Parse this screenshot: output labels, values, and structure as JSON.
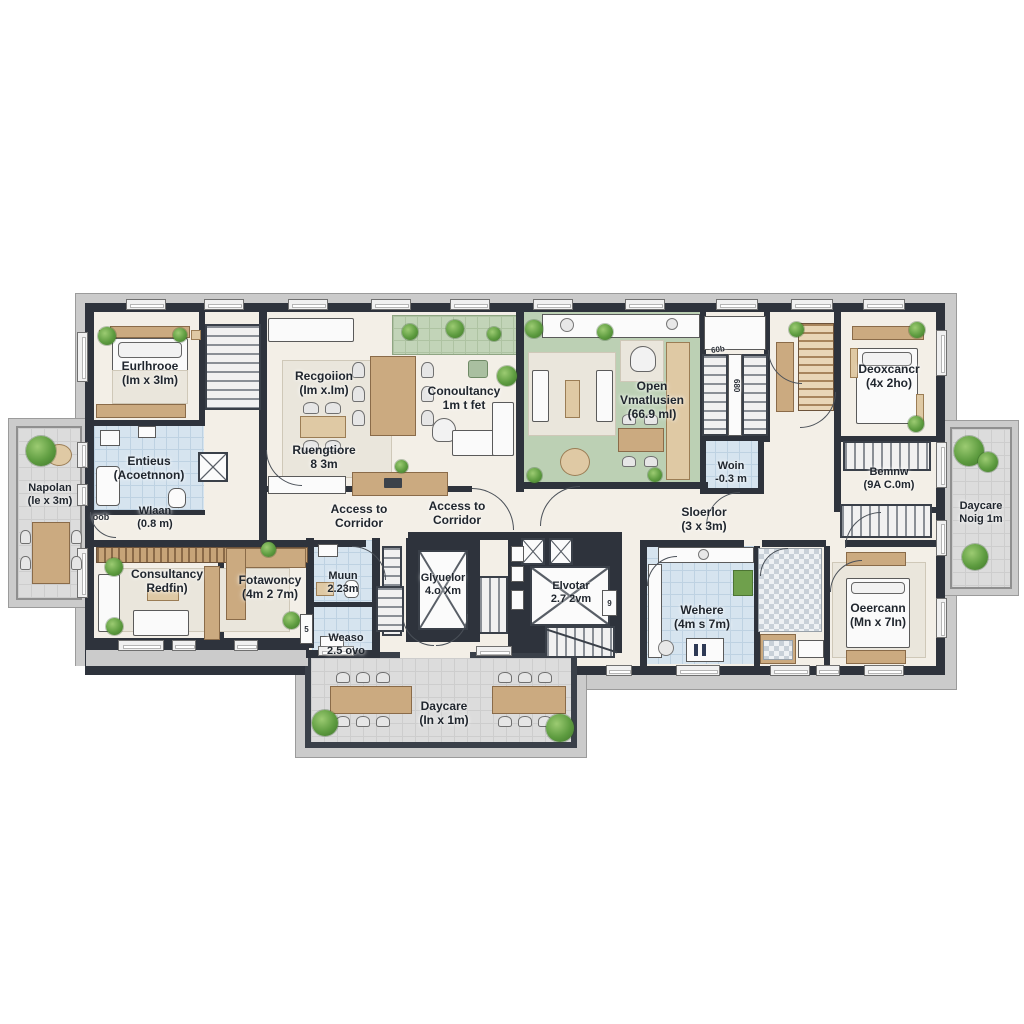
{
  "colors": {
    "wall": "#2e333c",
    "floor": "#f3efe7",
    "open_space_green": "#bcd0b4",
    "wet_room_blue": "#cfe0ec",
    "wood": "#cbaa80",
    "balcony_tile": "#dcdcdc",
    "plant": "#4e8a33"
  },
  "rooms": {
    "bedroom_tl": {
      "name": "Eurlhrooe",
      "dims": "(Im x 3Im)"
    },
    "bathroom_tl": {
      "name": "Entieus",
      "dims": "(Acoetnnon)"
    },
    "hall_tl": {
      "name": "Wlaan",
      "dims": "(0.8 m)",
      "tag": "oob"
    },
    "reception": {
      "name": "Recgoiion",
      "dims": "(Im x.Im)"
    },
    "reception_desk": {
      "name": "Ruengtiore",
      "dims": "8 3m"
    },
    "consultancy_top": {
      "name": "Conoultancy",
      "dims": "1m t fet"
    },
    "open_space": {
      "name": "Open",
      "name2": "Vmatlusien",
      "dims": "(66.9 mI)"
    },
    "woin": {
      "name": "Woin",
      "dims": "-0.3 m"
    },
    "bemnw": {
      "name": "Bemnw",
      "dims": "(9A C.0m)"
    },
    "bedroom_tr": {
      "name": "Deoxcancr",
      "dims": "(4x 2ho)"
    },
    "daycare_right": {
      "name": "Daycare",
      "dims": "Noig 1m"
    },
    "napolan": {
      "name": "Napolan",
      "dims": "(le x 3m)"
    },
    "consultancy_bl": {
      "name": "Consultancy",
      "dims": "Redfin)"
    },
    "fotawoncy": {
      "name": "Fotawoncy",
      "dims": "(4m 2 7m)"
    },
    "muun": {
      "name": "Muun",
      "dims": "2.23m"
    },
    "weaso": {
      "name": "Weaso",
      "dims": "2.5 ovo"
    },
    "elevator_left": {
      "name": "Glyuelor",
      "dims": "4.o Xm"
    },
    "elevator_right": {
      "name": "Elvotar",
      "dims": "2.7 2vm"
    },
    "wehere": {
      "name": "Wehere",
      "dims": "(4m s 7m)"
    },
    "deercann": {
      "name": "Oeercann",
      "dims": "(Mn x 7In)"
    },
    "daycare_bottom": {
      "name": "Daycare",
      "dims": "(In x 1m)"
    }
  },
  "corridor": {
    "access1": {
      "line1": "Access to",
      "line2": "Corridor"
    },
    "access2": {
      "line1": "Access to",
      "line2": "Corridor"
    },
    "sloerlor": {
      "name": "Sloerlor",
      "dims": "(3 x 3m)"
    }
  },
  "small_labels": {
    "shaft_top": "60b",
    "shaft_vertical": "680",
    "weaso_shaft": "5",
    "door_tag": "9"
  }
}
